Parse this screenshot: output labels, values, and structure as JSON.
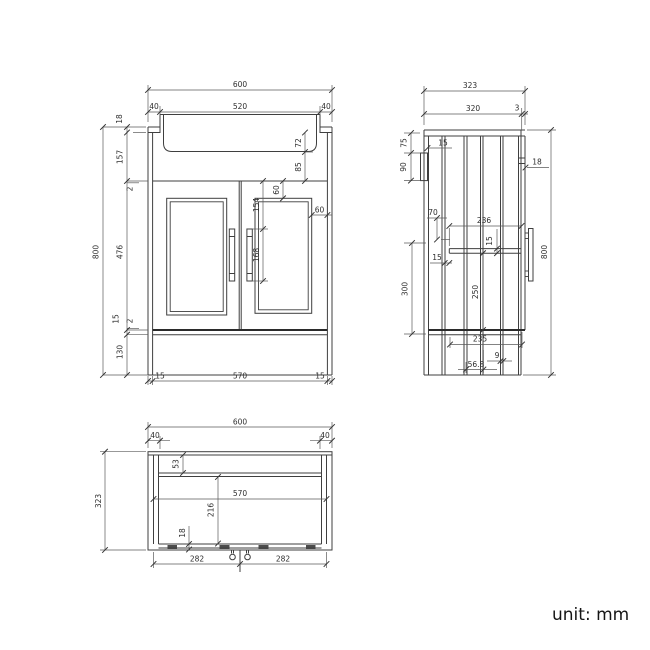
{
  "unit_label": "unit: mm",
  "views": {
    "front": {
      "label": "front view",
      "dims": {
        "overall_width": "600",
        "basin_offset_left": "40",
        "basin_width": "520",
        "basin_offset_right": "40",
        "counter_thickness": "18",
        "upper_section_height": "157",
        "door_top_gap": "2",
        "door_height": "476",
        "door_bottom_gap": "2",
        "bottom_rail_height": "15",
        "plinth_height": "130",
        "overall_height": "800",
        "basin_depth": "72",
        "basin_to_door": "85",
        "panel_top_inset": "60",
        "panel_side_inset": "60",
        "handle_offset_top": "154",
        "handle_length": "168",
        "plinth_inset_left": "15",
        "plinth_width": "570",
        "plinth_inset_right": "15"
      }
    },
    "side": {
      "label": "side view",
      "dims": {
        "overall_depth": "323",
        "carcass_depth": "320",
        "door_offset": "3",
        "bracket_offset_top": "75",
        "bracket_height": "90",
        "bracket_thickness": "15",
        "door_top_rail": "18",
        "back_rail_offset": "70",
        "interior_depth": "236",
        "shelf_thickness": "15",
        "shelf_back_gap": "15",
        "interior_height": "300",
        "shelf_to_bottom": "250",
        "bottom_interior_depth": "235",
        "pipe_gap": "9",
        "pipe_offset": "56.8",
        "overall_height": "800"
      }
    },
    "plan": {
      "label": "plan view",
      "dims": {
        "overall_width": "600",
        "side_offset_left": "40",
        "side_offset_right": "40",
        "overall_depth": "323",
        "back_rail_depth": "53",
        "interior_width": "570",
        "interior_depth": "216",
        "front_rail_thickness": "18",
        "handle_span_left": "282",
        "handle_span_right": "282"
      }
    }
  }
}
